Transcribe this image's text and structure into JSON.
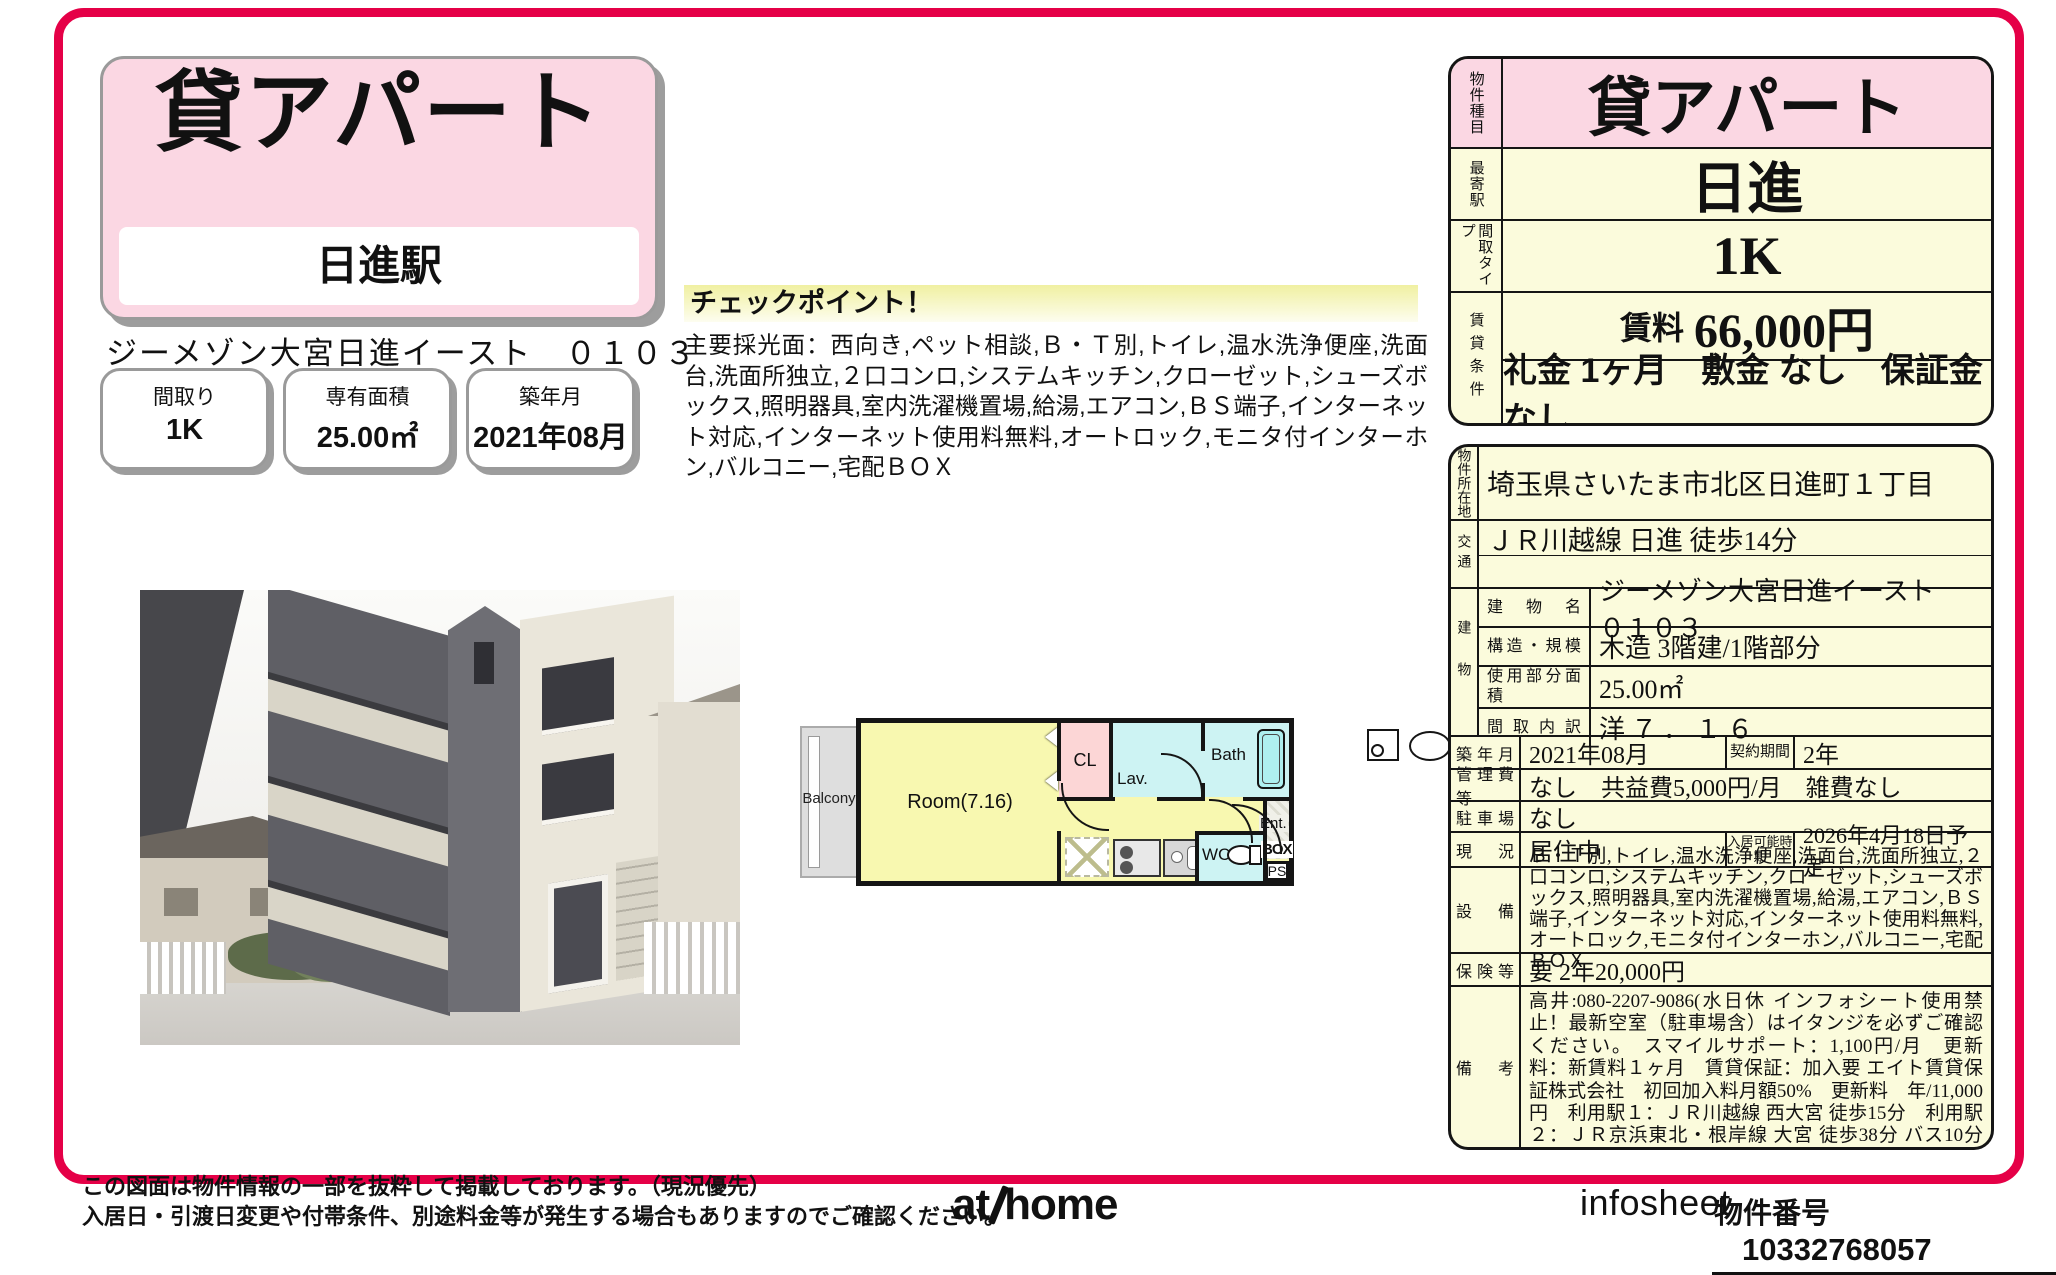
{
  "colors": {
    "frame_red": "#e50047",
    "pink": "#fbd7e3",
    "cream": "#fbfbdc"
  },
  "left": {
    "title_box": {
      "title": "貸アパート",
      "station": "日進駅"
    },
    "property_name": "ジーメゾン大宮日進イースト　０１０３",
    "summary_boxes": [
      {
        "label": "間取り",
        "value": "1K"
      },
      {
        "label": "専有面積",
        "value": "25.00㎡"
      },
      {
        "label": "築年月",
        "value": "2021年08月"
      }
    ],
    "checkpoint": {
      "title": "チェックポイント！",
      "body": "主要採光面：西向き,ペット相談,Ｂ・Ｔ別,トイレ,温水洗浄便座,洗面台,洗面所独立,２口コンロ,システムキッチン,クローゼット,シューズボックス,照明器具,室内洗濯機置場,給湯,エアコン,ＢＳ端子,インターネット対応,インターネット使用料無料,オートロック,モニタ付インターホン,バルコニー,宅配ＢＯＸ"
    },
    "floor_plan": {
      "balcony": "Balcony",
      "room": "Room(7.16)",
      "cl": "CL",
      "lav": "Lav.",
      "bath": "Bath",
      "wc": "WC",
      "ent": "Ent.",
      "box": "BOX",
      "ps": "PS"
    }
  },
  "info_table": {
    "type_label": "物件種目",
    "type_value": "貸アパート",
    "station_label": "最寄駅",
    "station_value": "日進",
    "layout_label": "間取タイプ",
    "layout_value": "1K",
    "terms_label": "賃貸条件",
    "rent_label": "賃料",
    "rent_value": "66,000円",
    "terms_detail": "礼金 1ヶ月　敷金 なし　保証金 なし"
  },
  "detail_table": {
    "location_label": "物件所在地",
    "location": "埼玉県さいたま市北区日進町１丁目",
    "access_label": "交通",
    "access1": "ＪＲ川越線 日進 徒歩14分",
    "access2": "",
    "building_label": "建物",
    "building_rows": [
      {
        "label": "建物名",
        "value": "ジーメゾン大宮日進イースト　０１０３"
      },
      {
        "label": "構造・規模",
        "value": "木造 3階建/1階部分"
      },
      {
        "label": "使用部分面積",
        "value": "25.00㎡"
      },
      {
        "label": "間取内訳",
        "value": "洋７．１６"
      }
    ],
    "built_label": "築年月",
    "built_value": "2021年08月",
    "contract_label": "契約期間",
    "contract_value": "2年",
    "fees_label": "管理費等",
    "fees_value": "なし　共益費5,000円/月　雑費なし",
    "parking_label": "駐車場",
    "parking_value": "なし",
    "status_label": "現況",
    "status_value": "居住中",
    "movein_label": "入居可能時期",
    "movein_value": "2026年4月18日予定",
    "equipment_label": "設備",
    "equipment_value": "Ｂ・Ｔ別,トイレ,温水洗浄便座,洗面台,洗面所独立,２口コンロ,システムキッチン,クローゼット,シューズボックス,照明器具,室内洗濯機置場,給湯,エアコン,ＢＳ端子,インターネット対応,インターネット使用料無料,オートロック,モニタ付インターホン,バルコニー,宅配ＢＯＸ",
    "insurance_label": "保険等",
    "insurance_value": "要 2年20,000円",
    "notes_label": "備考",
    "notes_value": "高井:080-2207-9086(水日休 インフォシート使用禁止！最新空室（駐車場含）はイタンジを必ずご確認ください。　スマイルサポート：1,100円/月　更新料：新賃料１ヶ月　賃貸保証：加入要 エイト賃貸保証株式会社　初回加入料月額50%　更新料　年/11,000円　利用駅１：ＪＲ川越線 西大宮 徒歩15分　利用駅２：ＪＲ京浜東北・根岸線 大宮 徒歩38分 バス10分 バス停 日進一丁目 停歩2分"
  },
  "footer": {
    "disclaimer1": "この図面は物件情報の一部を抜粋して掲載しております。（現況優先）",
    "disclaimer2": "入居日・引渡日変更や付帯条件、別途料金等が発生する場合もありますのでご確認ください。",
    "logo_at": "at",
    "logo_home": "home",
    "infosheet": "infosheet",
    "property_no_label": "物件番号",
    "property_no": "10332768057"
  }
}
